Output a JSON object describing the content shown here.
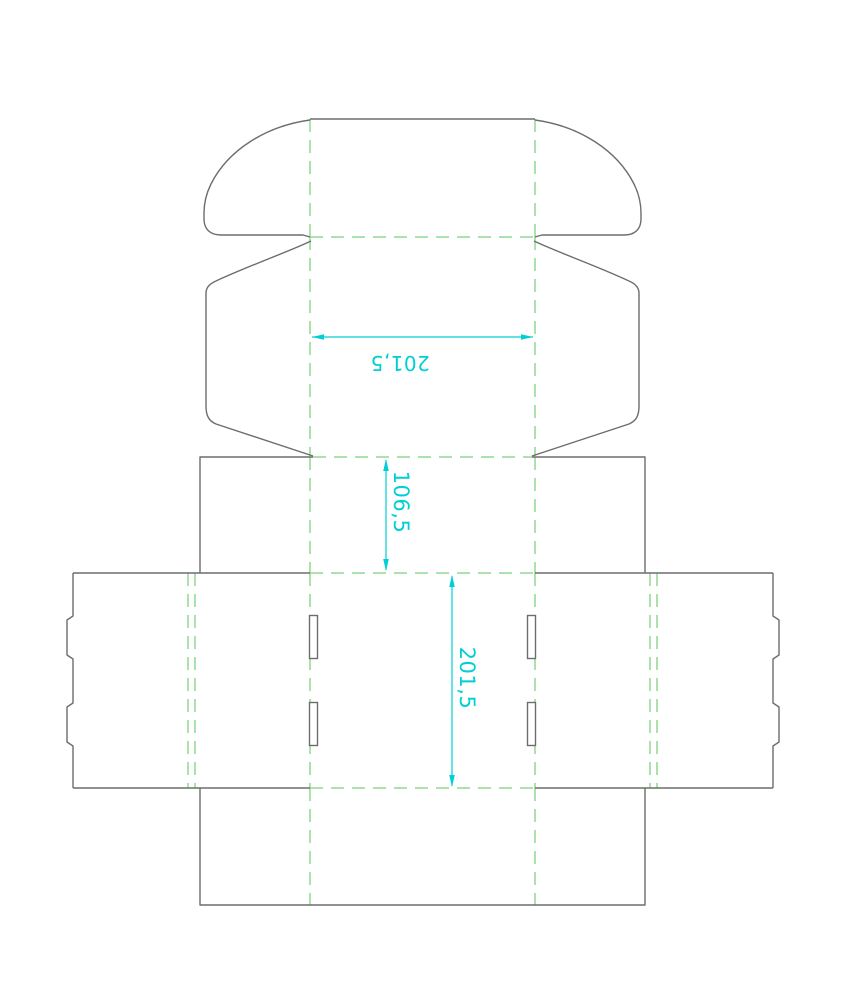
{
  "page": {
    "title": "box-dieline-template",
    "background": "#ffffff"
  },
  "diagram": {
    "kind": "packaging-dieline",
    "description": "Die-cut template (dieline) of a tuck-top mailer box showing cut lines, dashed fold lines and three dimension annotations",
    "line_styles": {
      "cut_line_color": "#6d6d6d",
      "fold_line_color": "#92d892",
      "dimension_color": "#00cfd4",
      "background_color": "#ffffff"
    },
    "dimensions": {
      "lid_width": {
        "value": "201,5",
        "orientation": "horizontal dimension line, label rotated 180°",
        "location": "lid top panel"
      },
      "front_height": {
        "value": "106,5",
        "orientation": "vertical dimension line, label rotated 90°",
        "location": "front wall panel"
      },
      "base_length": {
        "value": "201,5",
        "orientation": "vertical dimension line, label rotated 90°",
        "location": "main base panel"
      }
    }
  }
}
